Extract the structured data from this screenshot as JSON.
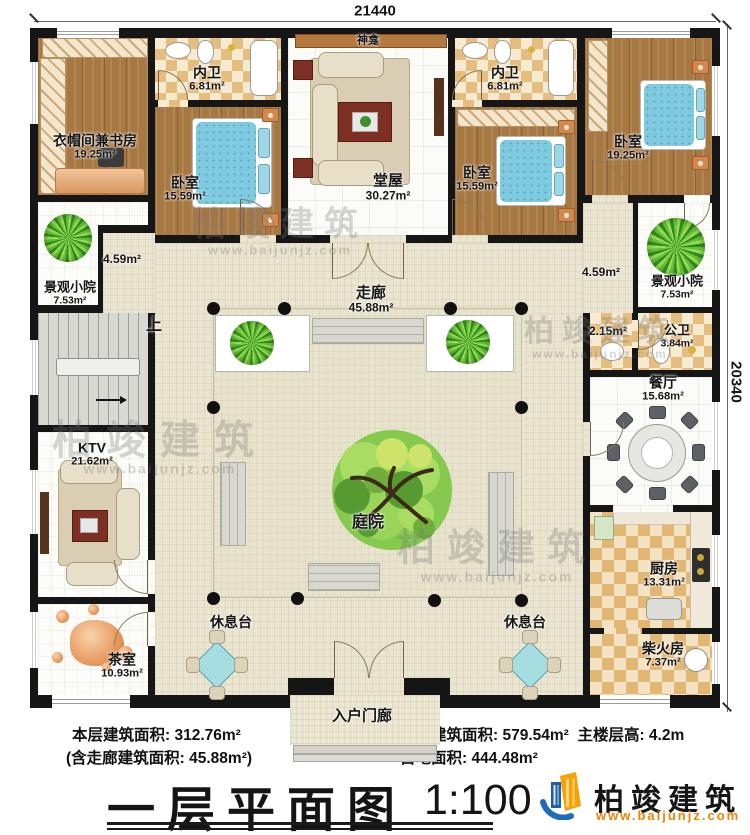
{
  "dimensions": {
    "top": "21440",
    "right": "20340"
  },
  "rooms": {
    "cloak_study": {
      "name": "衣帽间兼书房",
      "area": "19.25m²"
    },
    "inner_bath_left": {
      "name": "内卫",
      "area": "6.81m²"
    },
    "bedroom_left": {
      "name": "卧室",
      "area": "15.59m²"
    },
    "main_hall": {
      "name": "堂屋",
      "area": "30.27m²"
    },
    "shrine": {
      "name": "神龛"
    },
    "inner_bath_right": {
      "name": "内卫",
      "area": "6.81m²"
    },
    "bedroom_mid": {
      "name": "卧室",
      "area": "15.59m²"
    },
    "bedroom_right": {
      "name": "卧室",
      "area": "19.25m²"
    },
    "scenic_court_left": {
      "name": "景观小院",
      "area": "7.53m²"
    },
    "scenic_court_right": {
      "name": "景观小院",
      "area": "7.53m²"
    },
    "corridor": {
      "name": "走廊",
      "area": "45.88m²"
    },
    "corridor_left": {
      "area": "4.59m²"
    },
    "corridor_right": {
      "area": "4.59m²"
    },
    "washroom": {
      "area": "2.15m²"
    },
    "public_bath": {
      "name": "公卫",
      "area": "3.84m²"
    },
    "dining": {
      "name": "餐厅",
      "area": "15.68m²"
    },
    "ktv": {
      "name": "KTV",
      "area": "21.62m²"
    },
    "courtyard": {
      "name": "庭院"
    },
    "kitchen": {
      "name": "厨房",
      "area": "13.31m²"
    },
    "tea_room": {
      "name": "茶室",
      "area": "10.93m²"
    },
    "firewood": {
      "name": "柴火房",
      "area": "7.37m²"
    },
    "rest_platform_left": {
      "name": "休息台"
    },
    "rest_platform_right": {
      "name": "休息台"
    },
    "entry_porch": {
      "name": "入户门廊"
    },
    "stairs": {
      "name": "上"
    }
  },
  "footer": {
    "floor_area_label": "本层建筑面积: 312.76m²",
    "corridor_area_label": "(含走廊建筑面积: 45.88m²)",
    "building_area_label": "本栋建筑面积: 579.54m²",
    "floor_height_label": "主楼层高: 4.2m",
    "land_area_label": "占地面积: 444.48m²",
    "title": "一层平面图",
    "scale": "1:100"
  },
  "logo": {
    "name": "柏竣建筑",
    "website": "www.baijunjz.com"
  },
  "watermark": {
    "text": "柏竣建筑",
    "website": "www.baijunjz.com"
  }
}
